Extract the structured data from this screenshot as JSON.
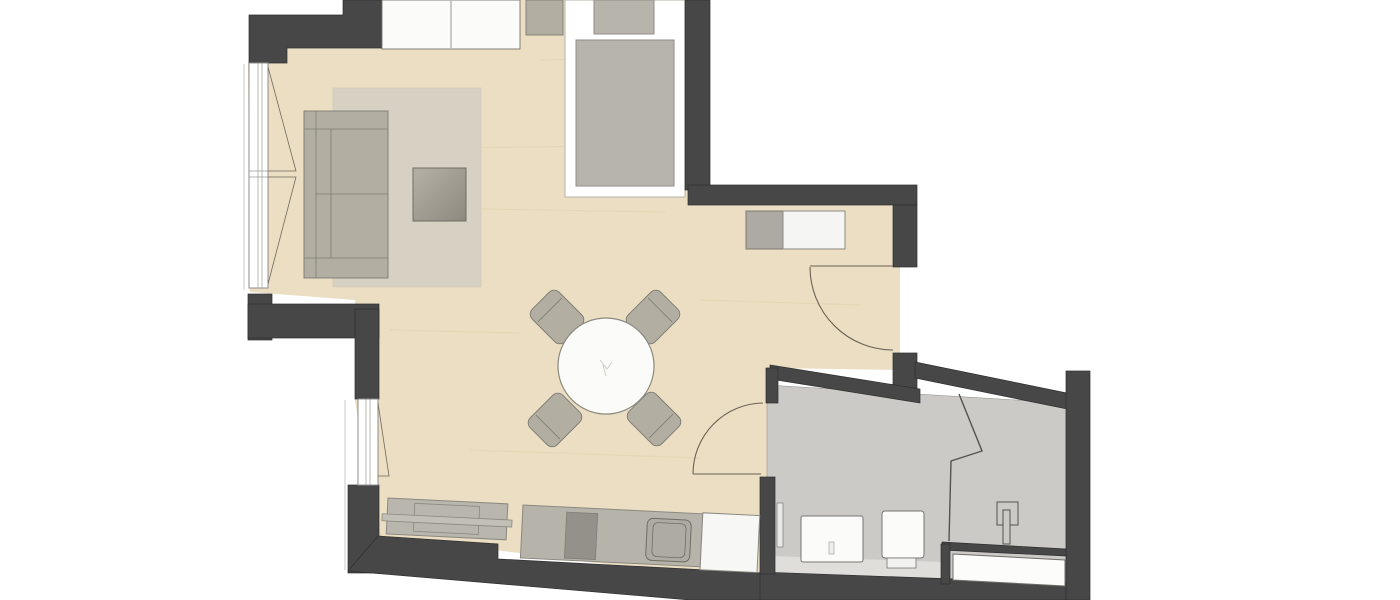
{
  "meta": {
    "kind": "apartment-floor-plan",
    "description": "Top-down 2D floor plan of a studio apartment with living/sleeping area, kitchenette and bathroom",
    "visible_text": "none"
  },
  "palette": {
    "bg": "#ffffff",
    "wall": "#474747",
    "wall-edge": "#2f2f2f",
    "floor": "#ebdec2",
    "floor-grain": "#ddcda9",
    "bath-floor": "#cbcac7",
    "bath-ledge": "#dfdedb",
    "alcove-floor": "#ffffff",
    "rug": "#d6d1c3",
    "furniture": "#b2afa2",
    "furniture-dark": "#939189",
    "white-fixture": "#fbfbfa",
    "outline": "#7e7c74",
    "door-line": "#6a6155",
    "window-frame": "#8c8c8c",
    "thin-line": "#c8c8c8"
  },
  "rooms": {
    "main": {
      "label": "Living / sleeping room",
      "floor": "wood"
    },
    "bathroom": {
      "label": "Bathroom",
      "floor": "tile"
    },
    "alcove": {
      "label": "Alcove niche",
      "floor": "white"
    }
  },
  "elements": {
    "sofa": "Sofa",
    "rug": "Area rug",
    "coffee_table": "Coffee table",
    "double_bed": "Double bed",
    "nightstand": "Nightstand",
    "alcove": "Alcove niche",
    "alcove_mat": "Alcove mat",
    "alcove_cabinet": "Alcove cabinet",
    "dining_table": "Round dining table",
    "dining_chair": "Dining chair",
    "sideboard": "Sideboard",
    "tv_lowboard": "TV lowboard",
    "kitchen_counter": "Kitchenette counter",
    "cooktop": "Cooktop",
    "kitchen_sink": "Kitchen sink",
    "refrigerator": "Refrigerator",
    "entrance_door": "Entrance door",
    "bathroom_door": "Bathroom door",
    "window_left_upper": "Casement windows",
    "window_left_lower": "Tilt window",
    "washbasin": "Washbasin",
    "toilet": "Toilet",
    "bathtub": "Bathtub",
    "shower_fixture": "Shower fixture",
    "towel_radiator": "Towel radiator",
    "glass_partition": "Bathroom partition"
  },
  "counts": {
    "dining_chairs": 4,
    "windows": 3,
    "doors": 2
  }
}
